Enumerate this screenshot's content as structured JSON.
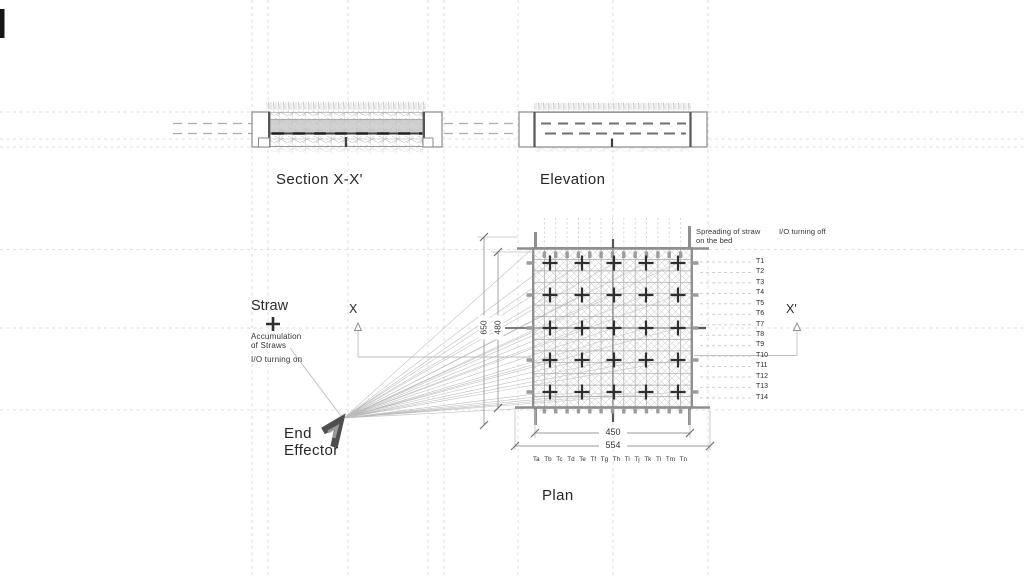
{
  "titles": {
    "section": "Section X-X'",
    "elevation": "Elevation",
    "plan": "Plan"
  },
  "annotations": {
    "straw": "Straw",
    "accumulation_line1": "Accumulation",
    "accumulation_line2": "of Straws",
    "io_on": "I/O turning on",
    "end_effector_line1": "End",
    "end_effector_line2": "Effector",
    "spreading_line1": "Spreading of straw",
    "spreading_line2": "on the bed",
    "io_off": "I/O turning off",
    "x_marker": "X",
    "x_prime_marker": "X'"
  },
  "dimensions": {
    "inner_width": "450",
    "outer_width": "554",
    "outer_height": "650",
    "inner_height": "480"
  },
  "plan_grid": {
    "row_labels": [
      "T1",
      "T2",
      "T3",
      "T4",
      "T5",
      "T6",
      "T7",
      "T8",
      "T9",
      "T10",
      "T11",
      "T12",
      "T13",
      "T14"
    ],
    "col_labels": [
      "Ta",
      "Tb",
      "Tc",
      "Td",
      "Te",
      "Tf",
      "Tg",
      "Th",
      "Ti",
      "Tj",
      "Tk",
      "Tl",
      "Tm",
      "Tn"
    ],
    "marker_rows": 5,
    "marker_cols": 5
  },
  "icons": {
    "straw_plus": "plus-icon",
    "end_effector": "gripper-icon",
    "section_direction": "up-arrow-icon"
  },
  "colors": {
    "background": "#ffffff",
    "construction": "#dcdcdc",
    "line_gray": "#8f8f8f",
    "dark": "#2f2f2f",
    "fan": "#b5b5b5",
    "straw_fill": "#c7c7c7"
  }
}
